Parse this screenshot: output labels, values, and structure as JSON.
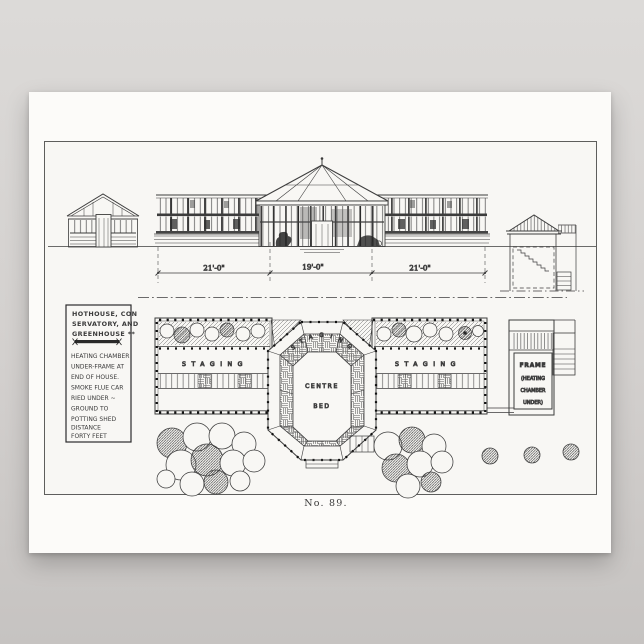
{
  "colors": {
    "background_top": "#dcdad8",
    "background_bottom": "#c6c3c1",
    "poster_paper": "#fcfbf9",
    "drawing_paper": "#f8f7f4",
    "ink": "#3a3a3a"
  },
  "poster": {
    "legend": {
      "title_lines": [
        "HOTHOUSE, CON",
        "SERVATORY, AND",
        "GREENHOUSE **"
      ],
      "body_lines": [
        "HEATING CHAMBER",
        "UNDER-FRAME AT",
        "END OF HOUSE.",
        "SMOKE FLUE CAR",
        "RIED UNDER ~",
        "GROUND  TO",
        "POTTING SHED",
        "DISTANCE",
        "FORTY FEET"
      ]
    },
    "dimensions": [
      "21'-0\"",
      "19'-0\"",
      "21'-0\""
    ],
    "plan": {
      "staging_left": "STAGING",
      "staging_right": "STAGING",
      "staging_arc": "STAGING",
      "centre": "CENTRE",
      "bed": "BED"
    },
    "frame": {
      "line1": "FRAME",
      "line2": "(HEATING",
      "line3": "CHAMBER",
      "line4": "UNDER)"
    },
    "caption": "No. 89."
  }
}
